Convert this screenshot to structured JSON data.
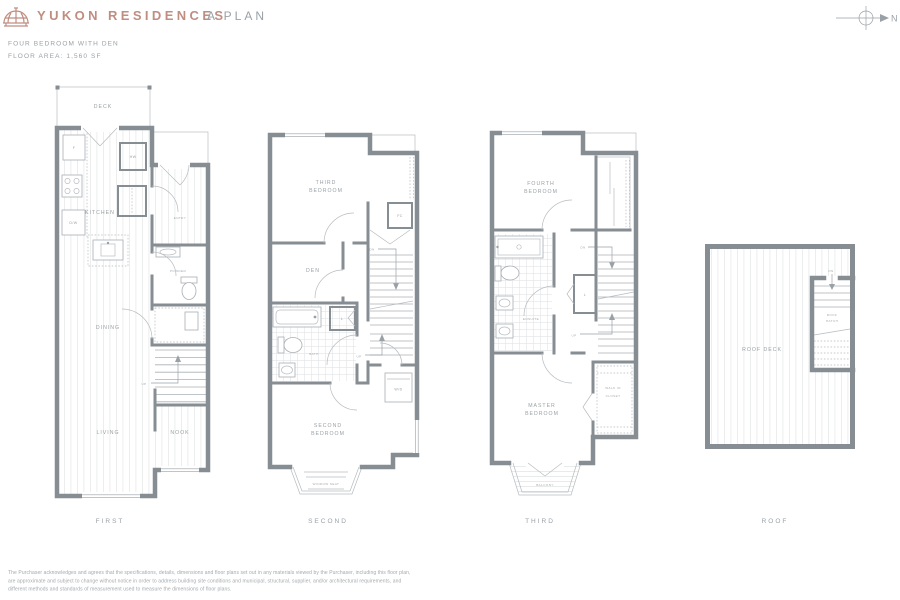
{
  "header": {
    "brand": "YUKON RESIDENCES",
    "plan": "A PLAN",
    "compass": "N"
  },
  "summary": {
    "type": "FOUR BEDROOM WITH DEN",
    "area": "FLOOR AREA: 1,560 SF"
  },
  "floors": {
    "first": {
      "label": "FIRST",
      "rooms": {
        "deck": "DECK",
        "kitchen": "KITCHEN",
        "entry": "ENTRY",
        "powder": "POWDER",
        "dining": "DINING",
        "living": "LIVING",
        "nook": "NOOK"
      },
      "fixtures": {
        "fridge": "F",
        "hot_water": "HW",
        "dishwasher": "D/W",
        "up": "UP"
      }
    },
    "second": {
      "label": "SECOND",
      "rooms": {
        "bedroom3_l1": "THIRD",
        "bedroom3_l2": "BEDROOM",
        "den": "DEN",
        "bath": "BATH",
        "bedroom2_l1": "SECOND",
        "bedroom2_l2": "BEDROOM",
        "window_seat": "WINDOW SEAT"
      },
      "fixtures": {
        "furnace": "FC",
        "linen": "L",
        "down": "DN",
        "up": "UP",
        "washer_dryer": "W/D"
      }
    },
    "third": {
      "label": "THIRD",
      "rooms": {
        "bedroom4_l1": "FOURTH",
        "bedroom4_l2": "BEDROOM",
        "ensuite": "ENSUITE",
        "walk_in_l1": "WALK IN",
        "walk_in_l2": "CLOSET",
        "master_l1": "MASTER",
        "master_l2": "BEDROOM",
        "balcony": "BALCONY"
      },
      "fixtures": {
        "linen": "L",
        "down": "DN",
        "up": "UP"
      }
    },
    "roof": {
      "label": "ROOF",
      "rooms": {
        "roof_deck": "ROOF DECK",
        "hatch_l1": "ROOF",
        "hatch_l2": "HATCH"
      },
      "fixtures": {
        "down": "DN"
      }
    }
  },
  "footer": {
    "disclaimer": "The Purchaser acknowledges and agrees that the specifications, details, dimensions and floor plans set out in any materials viewed by the Purchaser, including this floor plan, are approximate and subject to change without notice in order to address building site conditions and municipal, structural, supplier, and/or architectural requirements, and different methods and standards of measurement used to measure the dimensions of floor plans."
  },
  "colors": {
    "brand": "#c08d80",
    "wall": "#868d93",
    "label": "#9aa1a6"
  }
}
